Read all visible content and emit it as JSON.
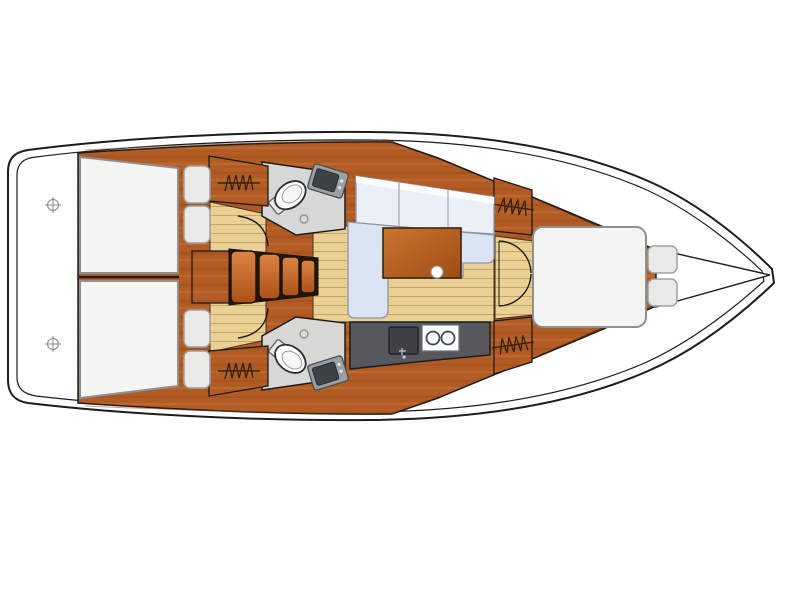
{
  "plan": {
    "kind": "sailing-yacht-interior-floor-plan",
    "view": "top-down",
    "orientation": {
      "bow": "right",
      "stern": "left"
    },
    "compartments": [
      {
        "id": "transom-platform",
        "label": "stern platform with two datum marks"
      },
      {
        "id": "aft-cabin-port",
        "label": "aft double cabin (top) with berth, two pillows, hanging locker"
      },
      {
        "id": "aft-cabin-starboard",
        "label": "aft double cabin (bottom) with berth, two pillows, hanging locker"
      },
      {
        "id": "head-port",
        "label": "head (top) with toilet and vanity sink"
      },
      {
        "id": "head-starboard",
        "label": "head (bottom) with toilet and vanity sink"
      },
      {
        "id": "companionway",
        "label": "companionway steps with engine box"
      },
      {
        "id": "saloon",
        "label": "saloon with L-shaped settee and wooden table"
      },
      {
        "id": "galley",
        "label": "galley with sink and two-burner stove"
      },
      {
        "id": "forward-cabin",
        "label": "forward cabin with island double berth and two pillows"
      },
      {
        "id": "bow",
        "label": "bow deck"
      }
    ],
    "counts": {
      "double_berths": 3,
      "pillows": 6,
      "heads": 2,
      "toilets": 2,
      "vanity_sinks": 2,
      "hanging_lockers": 4,
      "companionway_steps": 4,
      "stove_burners": 2,
      "door_swings": 4,
      "datum_marks": 2
    },
    "icons": [
      "toilet-icon",
      "vanity-sink-icon",
      "galley-sink-icon",
      "stove-icon",
      "hanging-locker-icon",
      "door-swing-icon",
      "crosshair-datum-icon",
      "table-leg-dot-icon"
    ]
  },
  "colors": {
    "line": "#1c1c1c",
    "wood": "#b05a24",
    "wood_light": "#cf7737",
    "wood_dark": "#8f4618",
    "floor": "#ead092",
    "floor_line": "#c4a062",
    "berth": "#f4f4f2",
    "berth_edge": "#8f8f8f",
    "pillow": "#e9e9e7",
    "sofa": "#dbe4f3",
    "sofa_light": "#ebeff8",
    "sofa_edge": "#8d95a5",
    "head_floor": "#d7d7d5",
    "counter": "#55585d",
    "sink": "#3e4246",
    "fixture": "#9aa0a6"
  }
}
